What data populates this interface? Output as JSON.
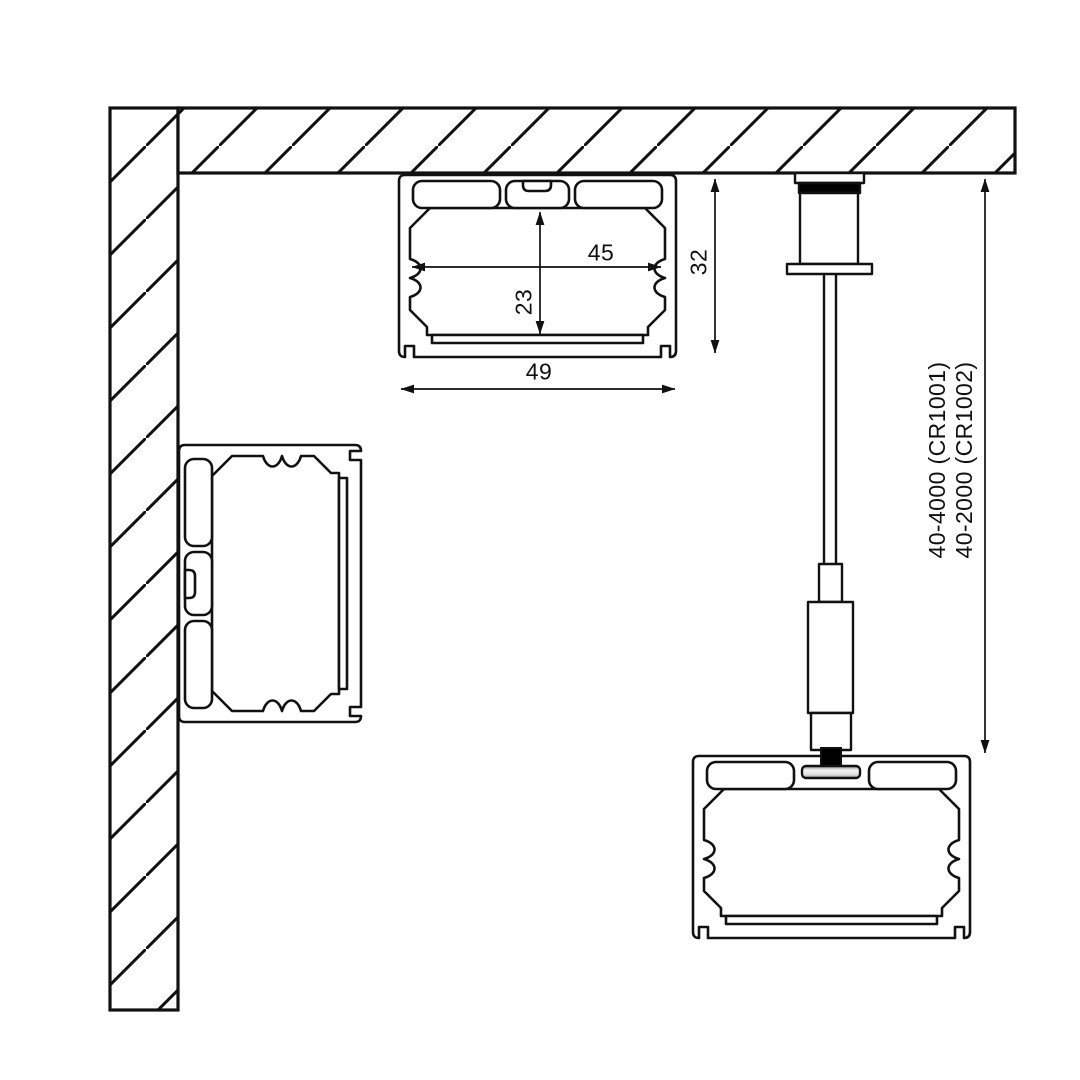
{
  "diagram": {
    "kind": "LED aluminium profile mounting cross-sections",
    "dimensions": {
      "inner_width": "45",
      "inner_height": "23",
      "outer_width": "49",
      "mounted_height": "32"
    },
    "suspension": {
      "label_line1": "40-4000 (CR1001)",
      "label_line2": "40-2000 (CR1002)"
    },
    "colors": {
      "line": "#111111",
      "background": "#ffffff",
      "fixture_black": "#000000",
      "disc_silver_light": "#f2f2f2",
      "disc_silver_dark": "#9a9a9a"
    }
  }
}
